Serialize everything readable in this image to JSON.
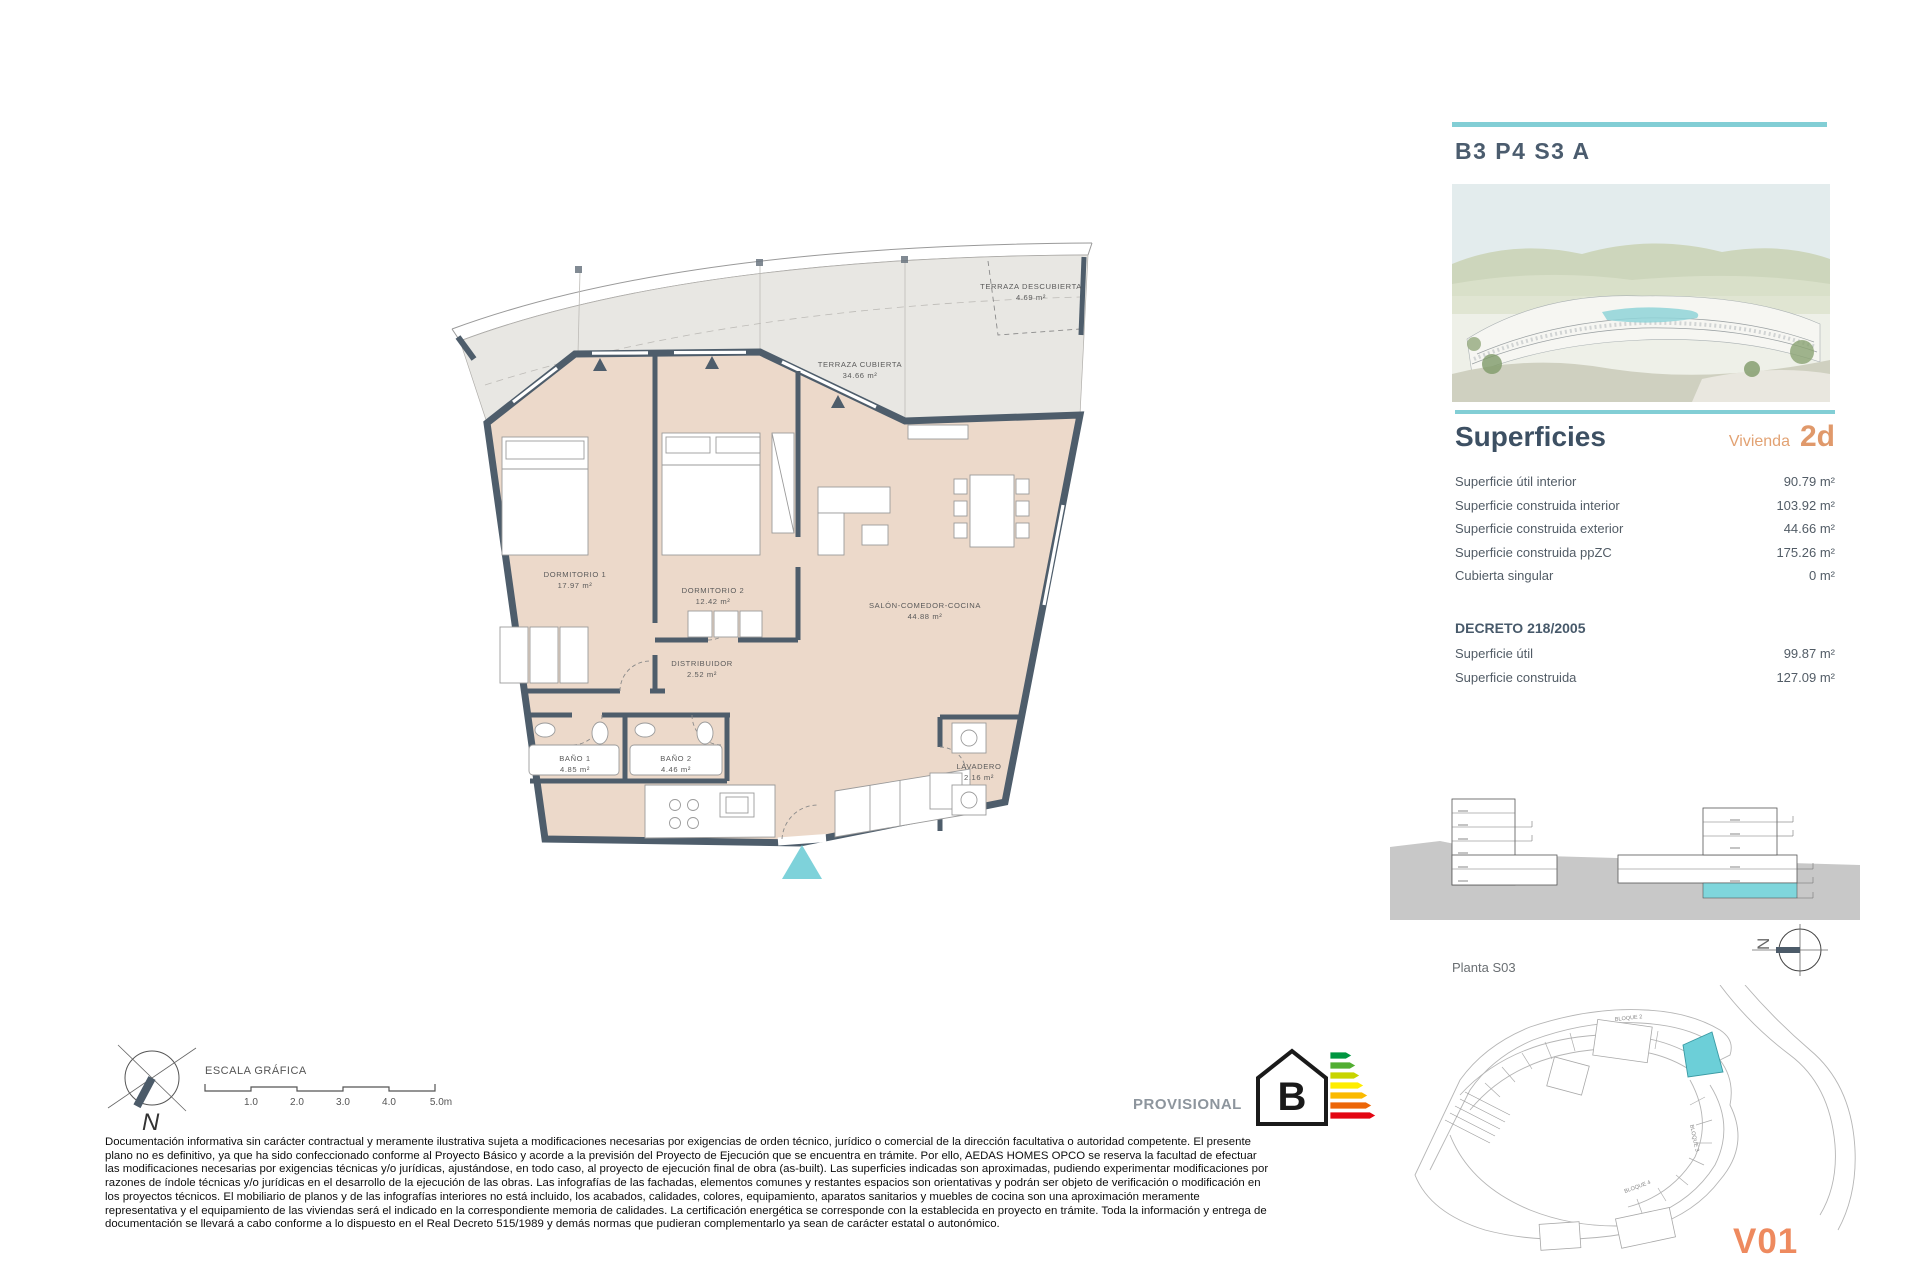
{
  "colors": {
    "teal_accent": "#82ced5",
    "orange_accent": "#e0996b",
    "heading_dark": "#3d5063",
    "wall": "#4e5d6b",
    "apartment_fill": "#ecd9ca",
    "terrace_fill": "#e8e7e3",
    "unit_highlight": "#6ccfd8"
  },
  "header": {
    "unit_code": "B3 P4 S3 A"
  },
  "superficies": {
    "title": "Superficies",
    "vivienda_label": "Vivienda",
    "vivienda_type": "2d",
    "rows": [
      {
        "label": "Superficie útil interior",
        "value": "90.79 m²"
      },
      {
        "label": "Superficie construida interior",
        "value": "103.92 m²"
      },
      {
        "label": "Superficie construida exterior",
        "value": "44.66 m²"
      },
      {
        "label": "Superficie construida ppZC",
        "value": "175.26 m²"
      },
      {
        "label": "Cubierta singular",
        "value": "0 m²"
      }
    ],
    "decreto": {
      "title": "DECRETO 218/2005",
      "rows": [
        {
          "label": "Superficie útil",
          "value": "99.87 m²"
        },
        {
          "label": "Superficie construida",
          "value": "127.09 m²"
        }
      ]
    }
  },
  "floor_plan": {
    "rooms": [
      {
        "name": "TERRAZA DESCUBIERTA",
        "area": "4.69 m²"
      },
      {
        "name": "TERRAZA CUBIERTA",
        "area": "34.66 m²"
      },
      {
        "name": "DORMITORIO 1",
        "area": "17.97 m²"
      },
      {
        "name": "DORMITORIO 2",
        "area": "12.42 m²"
      },
      {
        "name": "SALÓN-COMEDOR-COCINA",
        "area": "44.88 m²"
      },
      {
        "name": "DISTRIBUIDOR",
        "area": "2.52 m²"
      },
      {
        "name": "BAÑO 1",
        "area": "4.85 m²"
      },
      {
        "name": "BAÑO 2",
        "area": "4.46 m²"
      },
      {
        "name": "LAVADERO",
        "area": "2.16 m²"
      }
    ]
  },
  "elevation": {
    "floor_label": "Planta S03"
  },
  "site_plan": {
    "block_labels": [
      "BLOQUE 2",
      "BLOQUE 3",
      "BLOQUE 4"
    ],
    "sheet_code": "V01"
  },
  "scale_bar": {
    "label": "ESCALA GRÁFICA",
    "ticks": [
      "1.0",
      "2.0",
      "3.0",
      "4.0",
      "5.0m"
    ]
  },
  "compass": {
    "north_label": "N"
  },
  "energy_label": {
    "status": "PROVISIONAL",
    "rating": "B",
    "bar_colors": [
      "#009640",
      "#52ae32",
      "#c8d400",
      "#ffed00",
      "#fbba00",
      "#ec6608",
      "#e30613"
    ]
  },
  "disclaimer": {
    "lines": [
      "Documentación informativa sin carácter contractual y meramente ilustrativa sujeta a modificaciones necesarias por exigencias de orden técnico, jurídico o comercial de la dirección facultativa o autoridad competente. El presente",
      "plano no es definitivo, ya que ha sido confeccionado conforme al Proyecto Básico y acorde a la previsión del Proyecto de Ejecución que se encuentra en trámite. Por ello, AEDAS HOMES OPCO se reserva la facultad de efectuar",
      "las modificaciones necesarias por exigencias técnicas y/o jurídicas, ajustándose, en todo caso, al proyecto de ejecución final de obra (as-built). Las superficies indicadas son aproximadas, pudiendo experimentar modificaciones por",
      "razones de índole técnicas y/o jurídicas en el desarrollo de la ejecución de las obras. Las infografías de las fachadas, elementos comunes y restantes espacios son orientativas y podrán ser objeto de verificación o modificación en",
      "los proyectos técnicos. El mobiliario de planos y de las infografías interiores no está incluido, los acabados, calidades, colores, equipamiento, aparatos sanitarios y muebles de cocina son una aproximación meramente",
      "representativa y el equipamiento de las viviendas será el indicado en la correspondiente memoria de calidades. La certificación energética se corresponde con la establecida en proyecto en trámite. Toda la información y entrega de",
      "documentación se llevará a cabo conforme a lo dispuesto en el Real Decreto 515/1989 y demás normas que pudieran complementarlo ya sean de carácter estatal o autonómico."
    ]
  }
}
